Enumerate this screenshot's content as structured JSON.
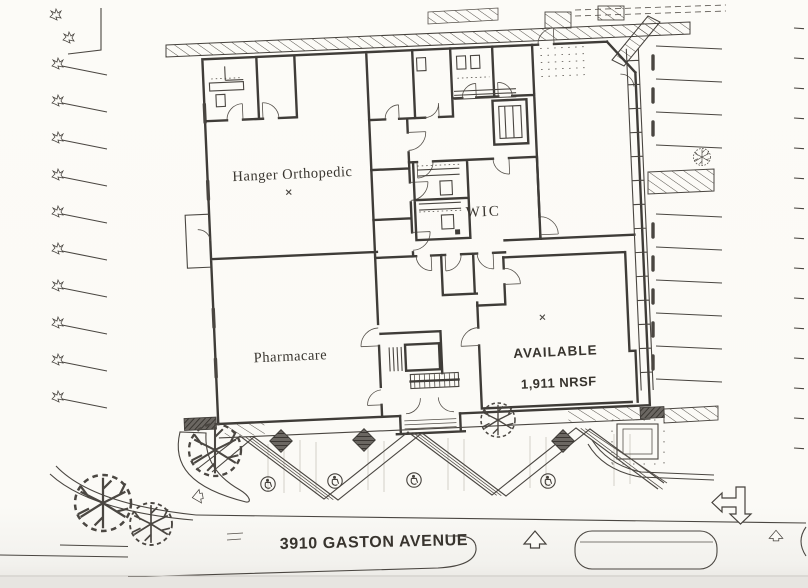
{
  "floor_plan": {
    "suites": [
      {
        "name": "Hanger Orthopedic"
      },
      {
        "name": "Pharmacare"
      },
      {
        "name": "WIC"
      },
      {
        "name": "AVAILABLE",
        "area": "1,911 NRSF"
      }
    ],
    "street": {
      "name": "3910 GASTON AVENUE"
    }
  },
  "colors": {
    "paper": "#fbfaf6",
    "ink": "#3f3c38",
    "text": "#38342e",
    "planter_dark": "#6b6762",
    "scan_edge": "#e7e5e1"
  },
  "symbols": {
    "tree": "deciduous-tree-icon",
    "shrub": "shrub-icon",
    "accessible_space": "wheelchair-icon",
    "traffic_arrow": "hollow-arrow-icon"
  }
}
